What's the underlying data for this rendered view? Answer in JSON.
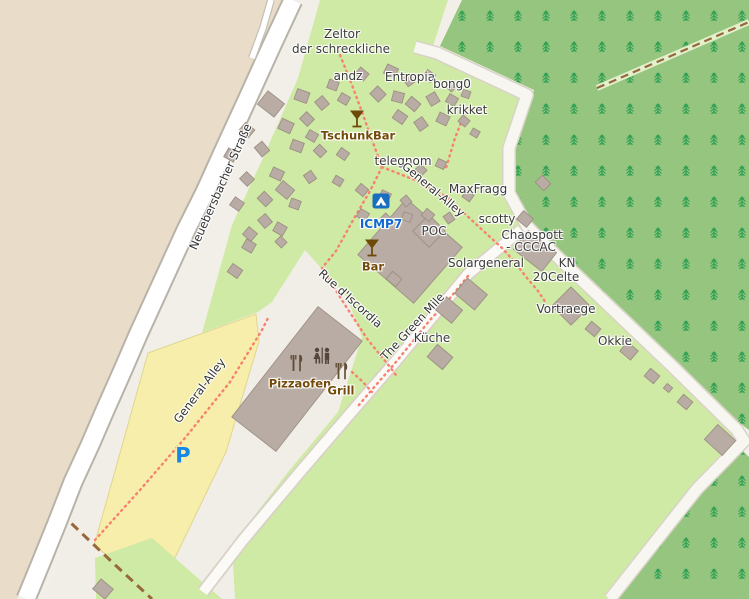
{
  "map": {
    "type": "openstreetmap-style camp site map",
    "colors": {
      "background": "#f2efe9",
      "farmland_beige": "#e9dcc8",
      "campsite_green": "#cfeaa4",
      "forest_green": "#95c57e",
      "tree_glyph": "#2fa052",
      "parking_yellow": "#f6eeaa",
      "parking_border": "#e0d68c",
      "building_fill": "#b8aca4",
      "building_stroke": "#9d9083",
      "road_fill": "#ffffff",
      "road_casing": "#b8b3a9",
      "footpath_red": "#f8806f",
      "track_brown": "#96683a",
      "amenity_label": "#734a08",
      "tourism_blue": "#1169d0",
      "parking_blue": "#1886e8"
    },
    "labels": [
      {
        "id": "label-zeltor-line1",
        "text": "Zeltor",
        "x": 342,
        "y": 34,
        "cls": "place"
      },
      {
        "id": "label-zeltor-line2",
        "text": "der schreckliche",
        "x": 341,
        "y": 49,
        "cls": "place"
      },
      {
        "id": "label-andz",
        "text": "andz",
        "x": 348,
        "y": 76,
        "cls": "place"
      },
      {
        "id": "label-entropia",
        "text": "Entropia",
        "x": 410,
        "y": 77,
        "cls": "place"
      },
      {
        "id": "label-bong0",
        "text": "bong0",
        "x": 452,
        "y": 84,
        "cls": "place"
      },
      {
        "id": "label-krikket",
        "text": "krikket",
        "x": 467,
        "y": 110,
        "cls": "place"
      },
      {
        "id": "label-telegnom",
        "text": "telegnom",
        "x": 403,
        "y": 161,
        "cls": "place"
      },
      {
        "id": "label-maxfragg",
        "text": "MaxFragg",
        "x": 478,
        "y": 189,
        "cls": "place"
      },
      {
        "id": "label-scotty",
        "text": "scotty",
        "x": 497,
        "y": 219,
        "cls": "place"
      },
      {
        "id": "label-chaospott-line1",
        "text": "Chaospott",
        "x": 532,
        "y": 235,
        "cls": "place"
      },
      {
        "id": "label-chaospott-line2",
        "text": "- CCCAC",
        "x": 531,
        "y": 247,
        "cls": "place"
      },
      {
        "id": "label-kn",
        "text": "KN",
        "x": 567,
        "y": 263,
        "cls": "place"
      },
      {
        "id": "label-20celte",
        "text": "20Celte",
        "x": 556,
        "y": 277,
        "cls": "place"
      },
      {
        "id": "label-solargeneral",
        "text": "Solargeneral",
        "x": 486,
        "y": 263,
        "cls": "place"
      },
      {
        "id": "label-vortraege",
        "text": "Vortraege",
        "x": 566,
        "y": 309,
        "cls": "place"
      },
      {
        "id": "label-okkie",
        "text": "Okkie",
        "x": 615,
        "y": 341,
        "cls": "place"
      },
      {
        "id": "label-kueche",
        "text": "Küche",
        "x": 432,
        "y": 338,
        "cls": "place"
      },
      {
        "id": "label-poc",
        "text": "POC",
        "x": 434,
        "y": 231,
        "cls": "place"
      },
      {
        "id": "label-neuebersbacher-strasse",
        "text": "Neuebersbacher Straße",
        "x": 221,
        "y": 187,
        "cls": "road",
        "rot": -66
      },
      {
        "id": "label-general-alley-north",
        "text": "General-Alley",
        "x": 433,
        "y": 190,
        "cls": "road",
        "rot": 40
      },
      {
        "id": "label-rue-discordia",
        "text": "Rue d'Iscordia",
        "x": 350,
        "y": 299,
        "cls": "road",
        "rot": 42
      },
      {
        "id": "label-the-green-mile",
        "text": "The Green Mile",
        "x": 413,
        "y": 327,
        "cls": "road",
        "rot": -47
      },
      {
        "id": "label-general-alley-south",
        "text": "General-Alley",
        "x": 200,
        "y": 391,
        "cls": "road",
        "rot": -53
      },
      {
        "id": "label-tschunkbar",
        "text": "TschunkBar",
        "x": 358,
        "y": 136,
        "cls": "amenity"
      },
      {
        "id": "label-bar",
        "text": "Bar",
        "x": 373,
        "y": 267,
        "cls": "amenity"
      },
      {
        "id": "label-pizzaofen",
        "text": "Pizzaofen",
        "x": 300,
        "y": 384,
        "cls": "amenity"
      },
      {
        "id": "label-grill",
        "text": "Grill",
        "x": 341,
        "y": 391,
        "cls": "amenity"
      },
      {
        "id": "label-icmp7",
        "text": "ICMP7",
        "x": 381,
        "y": 224,
        "cls": "poi-blue"
      },
      {
        "id": "label-parking-p",
        "text": "P",
        "x": 183,
        "y": 456,
        "cls": "parking"
      }
    ],
    "icons": [
      {
        "name": "cocktail-icon",
        "for": "TschunkBar",
        "x": 357,
        "y": 120
      },
      {
        "name": "cocktail-icon",
        "for": "Bar",
        "x": 372,
        "y": 249
      },
      {
        "name": "campsite-icon",
        "for": "ICMP7",
        "x": 381,
        "y": 201
      },
      {
        "name": "toilets-icon",
        "for": "toilets",
        "x": 322,
        "y": 357
      },
      {
        "name": "restaurant-icon",
        "for": "Pizzaofen",
        "x": 297,
        "y": 363
      },
      {
        "name": "restaurant-icon",
        "for": "Grill",
        "x": 342,
        "y": 371
      }
    ],
    "buildings": [
      [
        410,
        251,
        74,
        74,
        41
      ],
      [
        429,
        231,
        23,
        23,
        45
      ],
      [
        297,
        379,
        56,
        140,
        38
      ],
      [
        535,
        251,
        36,
        24,
        38
      ],
      [
        571,
        306,
        27,
        27,
        45
      ],
      [
        471,
        294,
        26,
        20,
        40
      ],
      [
        449,
        310,
        21,
        17,
        40
      ],
      [
        440,
        357,
        20,
        16,
        40
      ],
      [
        720,
        440,
        24,
        20,
        42
      ],
      [
        629,
        351,
        14,
        12,
        40
      ],
      [
        652,
        376,
        12,
        10,
        40
      ],
      [
        668,
        388,
        7,
        6,
        40
      ],
      [
        685,
        402,
        12,
        10,
        40
      ],
      [
        593,
        329,
        12,
        10,
        40
      ],
      [
        543,
        183,
        12,
        10,
        45
      ],
      [
        525,
        219,
        13,
        11,
        40
      ],
      [
        103,
        589,
        16,
        13,
        40
      ],
      [
        285,
        190,
        15,
        12,
        40
      ],
      [
        265,
        221,
        11,
        10,
        50
      ],
      [
        249,
        246,
        11,
        10,
        30
      ],
      [
        281,
        242,
        9,
        8,
        45
      ],
      [
        235,
        271,
        12,
        10,
        35
      ],
      [
        271,
        104,
        21,
        17,
        38
      ],
      [
        302,
        96,
        13,
        11,
        20
      ],
      [
        322,
        103,
        11,
        10,
        50
      ],
      [
        344,
        99,
        10,
        9,
        30
      ],
      [
        378,
        94,
        12,
        11,
        45
      ],
      [
        398,
        97,
        11,
        10,
        15
      ],
      [
        413,
        104,
        12,
        10,
        40
      ],
      [
        433,
        99,
        11,
        10,
        60
      ],
      [
        452,
        100,
        10,
        9,
        30
      ],
      [
        333,
        85,
        10,
        9,
        20
      ],
      [
        362,
        74,
        11,
        9,
        40
      ],
      [
        391,
        71,
        12,
        10,
        25
      ],
      [
        409,
        80,
        10,
        9,
        55
      ],
      [
        429,
        76,
        10,
        9,
        35
      ],
      [
        451,
        86,
        9,
        8,
        45
      ],
      [
        466,
        94,
        8,
        7,
        20
      ],
      [
        247,
        130,
        12,
        10,
        40
      ],
      [
        286,
        126,
        13,
        11,
        25
      ],
      [
        307,
        119,
        11,
        10,
        45
      ],
      [
        400,
        117,
        12,
        10,
        35
      ],
      [
        421,
        124,
        11,
        10,
        55
      ],
      [
        443,
        119,
        11,
        10,
        25
      ],
      [
        464,
        121,
        9,
        8,
        40
      ],
      [
        231,
        155,
        11,
        10,
        30
      ],
      [
        262,
        149,
        12,
        10,
        50
      ],
      [
        297,
        146,
        12,
        10,
        20
      ],
      [
        320,
        151,
        10,
        9,
        45
      ],
      [
        312,
        136,
        10,
        9,
        30
      ],
      [
        343,
        154,
        10,
        9,
        35
      ],
      [
        247,
        179,
        11,
        10,
        45
      ],
      [
        277,
        174,
        12,
        10,
        25
      ],
      [
        310,
        177,
        10,
        9,
        55
      ],
      [
        338,
        181,
        9,
        8,
        30
      ],
      [
        237,
        204,
        11,
        10,
        35
      ],
      [
        265,
        199,
        12,
        10,
        45
      ],
      [
        295,
        204,
        10,
        9,
        20
      ],
      [
        250,
        234,
        11,
        10,
        40
      ],
      [
        280,
        229,
        11,
        10,
        30
      ],
      [
        362,
        190,
        10,
        9,
        40
      ],
      [
        385,
        196,
        10,
        9,
        25
      ],
      [
        406,
        201,
        9,
        8,
        50
      ],
      [
        363,
        215,
        10,
        9,
        30
      ],
      [
        386,
        219,
        9,
        8,
        45
      ],
      [
        407,
        217,
        9,
        8,
        20
      ],
      [
        428,
        215,
        10,
        9,
        40
      ],
      [
        449,
        218,
        9,
        8,
        55
      ],
      [
        468,
        196,
        9,
        8,
        35
      ],
      [
        421,
        170,
        9,
        8,
        45
      ],
      [
        441,
        164,
        9,
        8,
        25
      ],
      [
        475,
        133,
        8,
        7,
        30
      ],
      [
        394,
        279,
        12,
        10,
        40
      ]
    ]
  }
}
